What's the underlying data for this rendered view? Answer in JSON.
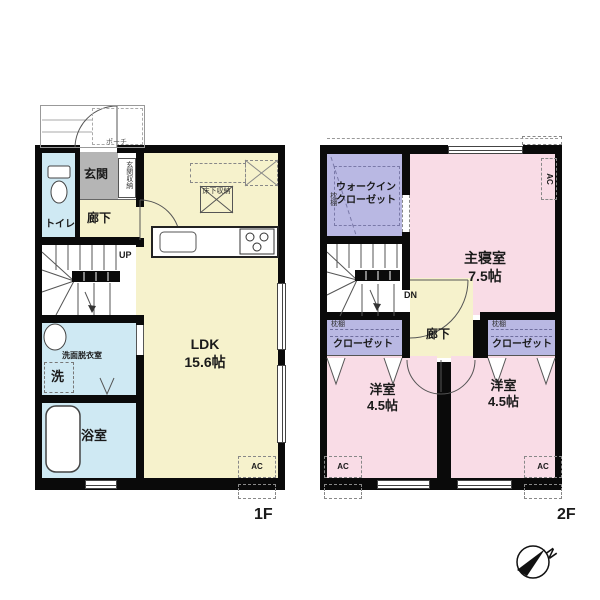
{
  "f1": {
    "floor_label": "1F",
    "porch": "ポーチ",
    "genkan": "玄関",
    "genkan_storage": "玄関収納",
    "hallway": "廊下",
    "toilet": "トイレ",
    "up": "UP",
    "washroom": "洗面脱衣室",
    "washer": "洗",
    "bath": "浴室",
    "ldk_name": "LDK",
    "ldk_size": "15.6帖",
    "floor_storage": "床下収納",
    "ac": "AC"
  },
  "f2": {
    "floor_label": "2F",
    "wic_line1": "ウォークイン",
    "wic_line2": "クローゼット",
    "shelf": "枕棚",
    "master_name": "主寝室",
    "master_size": "7.5帖",
    "dn": "DN",
    "hallway": "廊下",
    "closet": "クローゼット",
    "west_name": "洋室",
    "west_size": "4.5帖",
    "ac": "AC"
  },
  "compass": {
    "north": "N"
  },
  "colors": {
    "wall": "#0a0a0a",
    "ldk_yellow": "#f6f2cc",
    "wet_blue": "#cfe9f3",
    "genkan_gray": "#b5b5b5",
    "closet_purple": "#b9b8e3",
    "bedroom_pink": "#f9dce6"
  }
}
